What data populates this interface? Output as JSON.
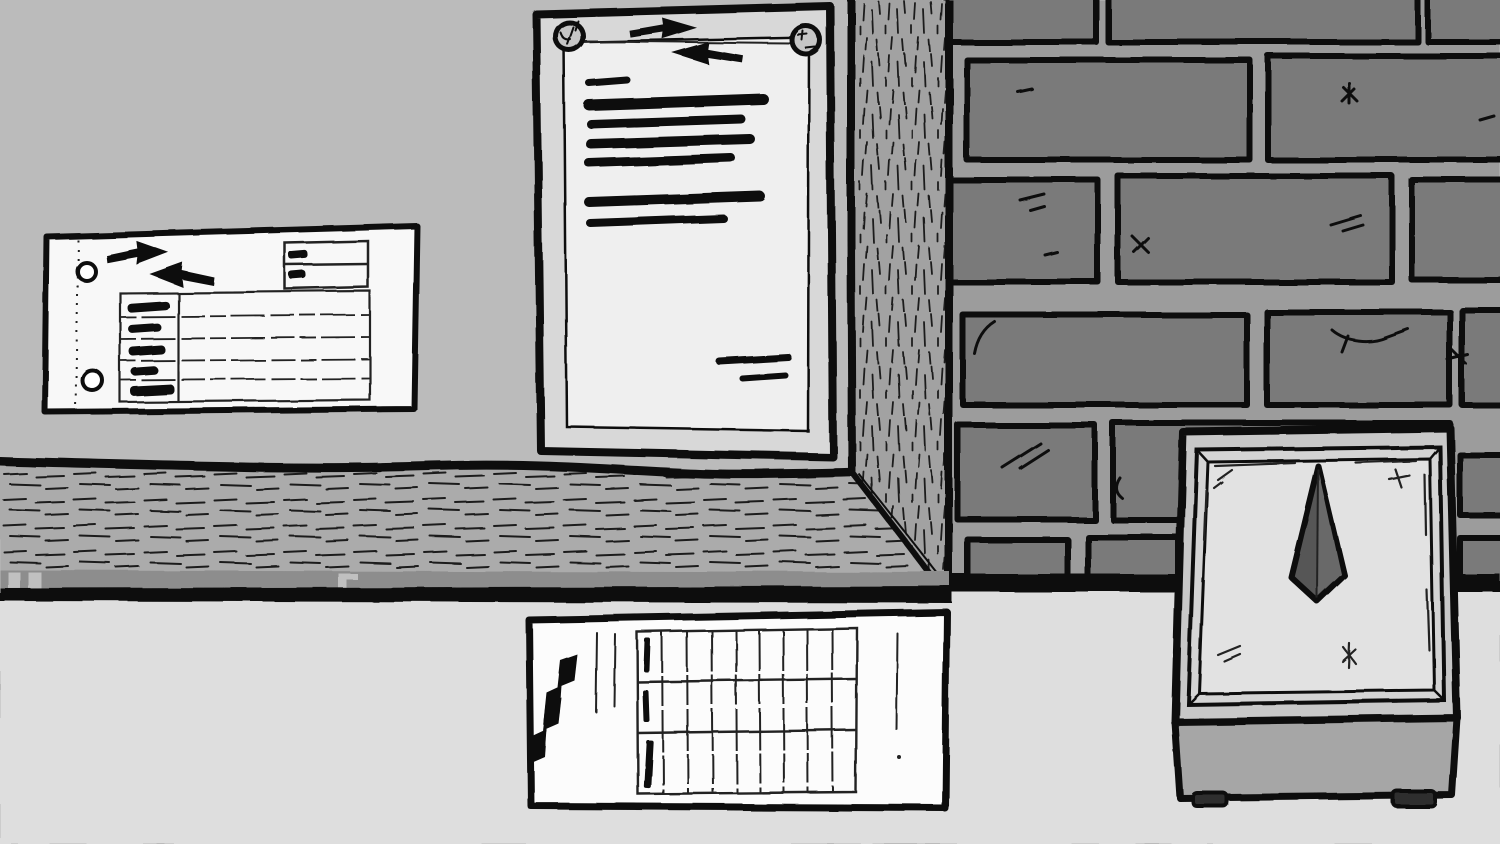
{
  "scene": {
    "setting": "hand-drawn monochrome back-room with brick wall, wooden corner post, wall shelf and desk",
    "style": "black-and-white comic ink illustration, no readable text (all writing is redacted ink bars)"
  },
  "palette": {
    "wall_upper": "#bbbbbb",
    "wall_lower": "#dedede",
    "mortar": "#9c9c9c",
    "brick": "#7a7a7a",
    "wood_post": "#a2a2a2",
    "wood_shelf": "#ababab",
    "shelf_rail": "#8d8d8d",
    "notch": "#c0c0c0",
    "paper_note": "#f8f8f8",
    "frame": "#d8d8d8",
    "frame_paper": "#efefef",
    "pin": "#c6c6c6",
    "paper_form": "#fcfcfc",
    "scale_body": "#c8c8c8",
    "scale_bevel": "#d4d4d4",
    "scale_face": "#e2e2e2",
    "scale_base": "#a6a6a6",
    "needle": "#575757",
    "needle_light": "#696969",
    "feet": "#2e2e2e",
    "ink": "#111111"
  },
  "objects": {
    "wall_note": {
      "description": "pinned paper slip with double-lightning logo",
      "punch_holes": 2,
      "info_box_rows": 2,
      "table_rows": 5,
      "table_label_column": true
    },
    "framed_document": {
      "description": "framed notice pinned with two round pins, text fully redacted",
      "pins": 2,
      "redacted_lines": 7,
      "signature_lines": 2
    },
    "timesheet_form": {
      "description": "desk form with vertical double-lightning logo and punch grid",
      "grid_rows": 3,
      "grid_columns": 9,
      "filled_first_column_ticks": 3
    },
    "dial_scale": {
      "description": "boxy dial device with dark needle pointing straight up",
      "needle_direction": "up",
      "feet": 2
    },
    "environment": {
      "brick_rows_visible": 6,
      "wooden_post": "vertical grain, right of framed document",
      "shelf": "horizontal plank spanning left half",
      "shelf_support_notches": 3
    }
  }
}
